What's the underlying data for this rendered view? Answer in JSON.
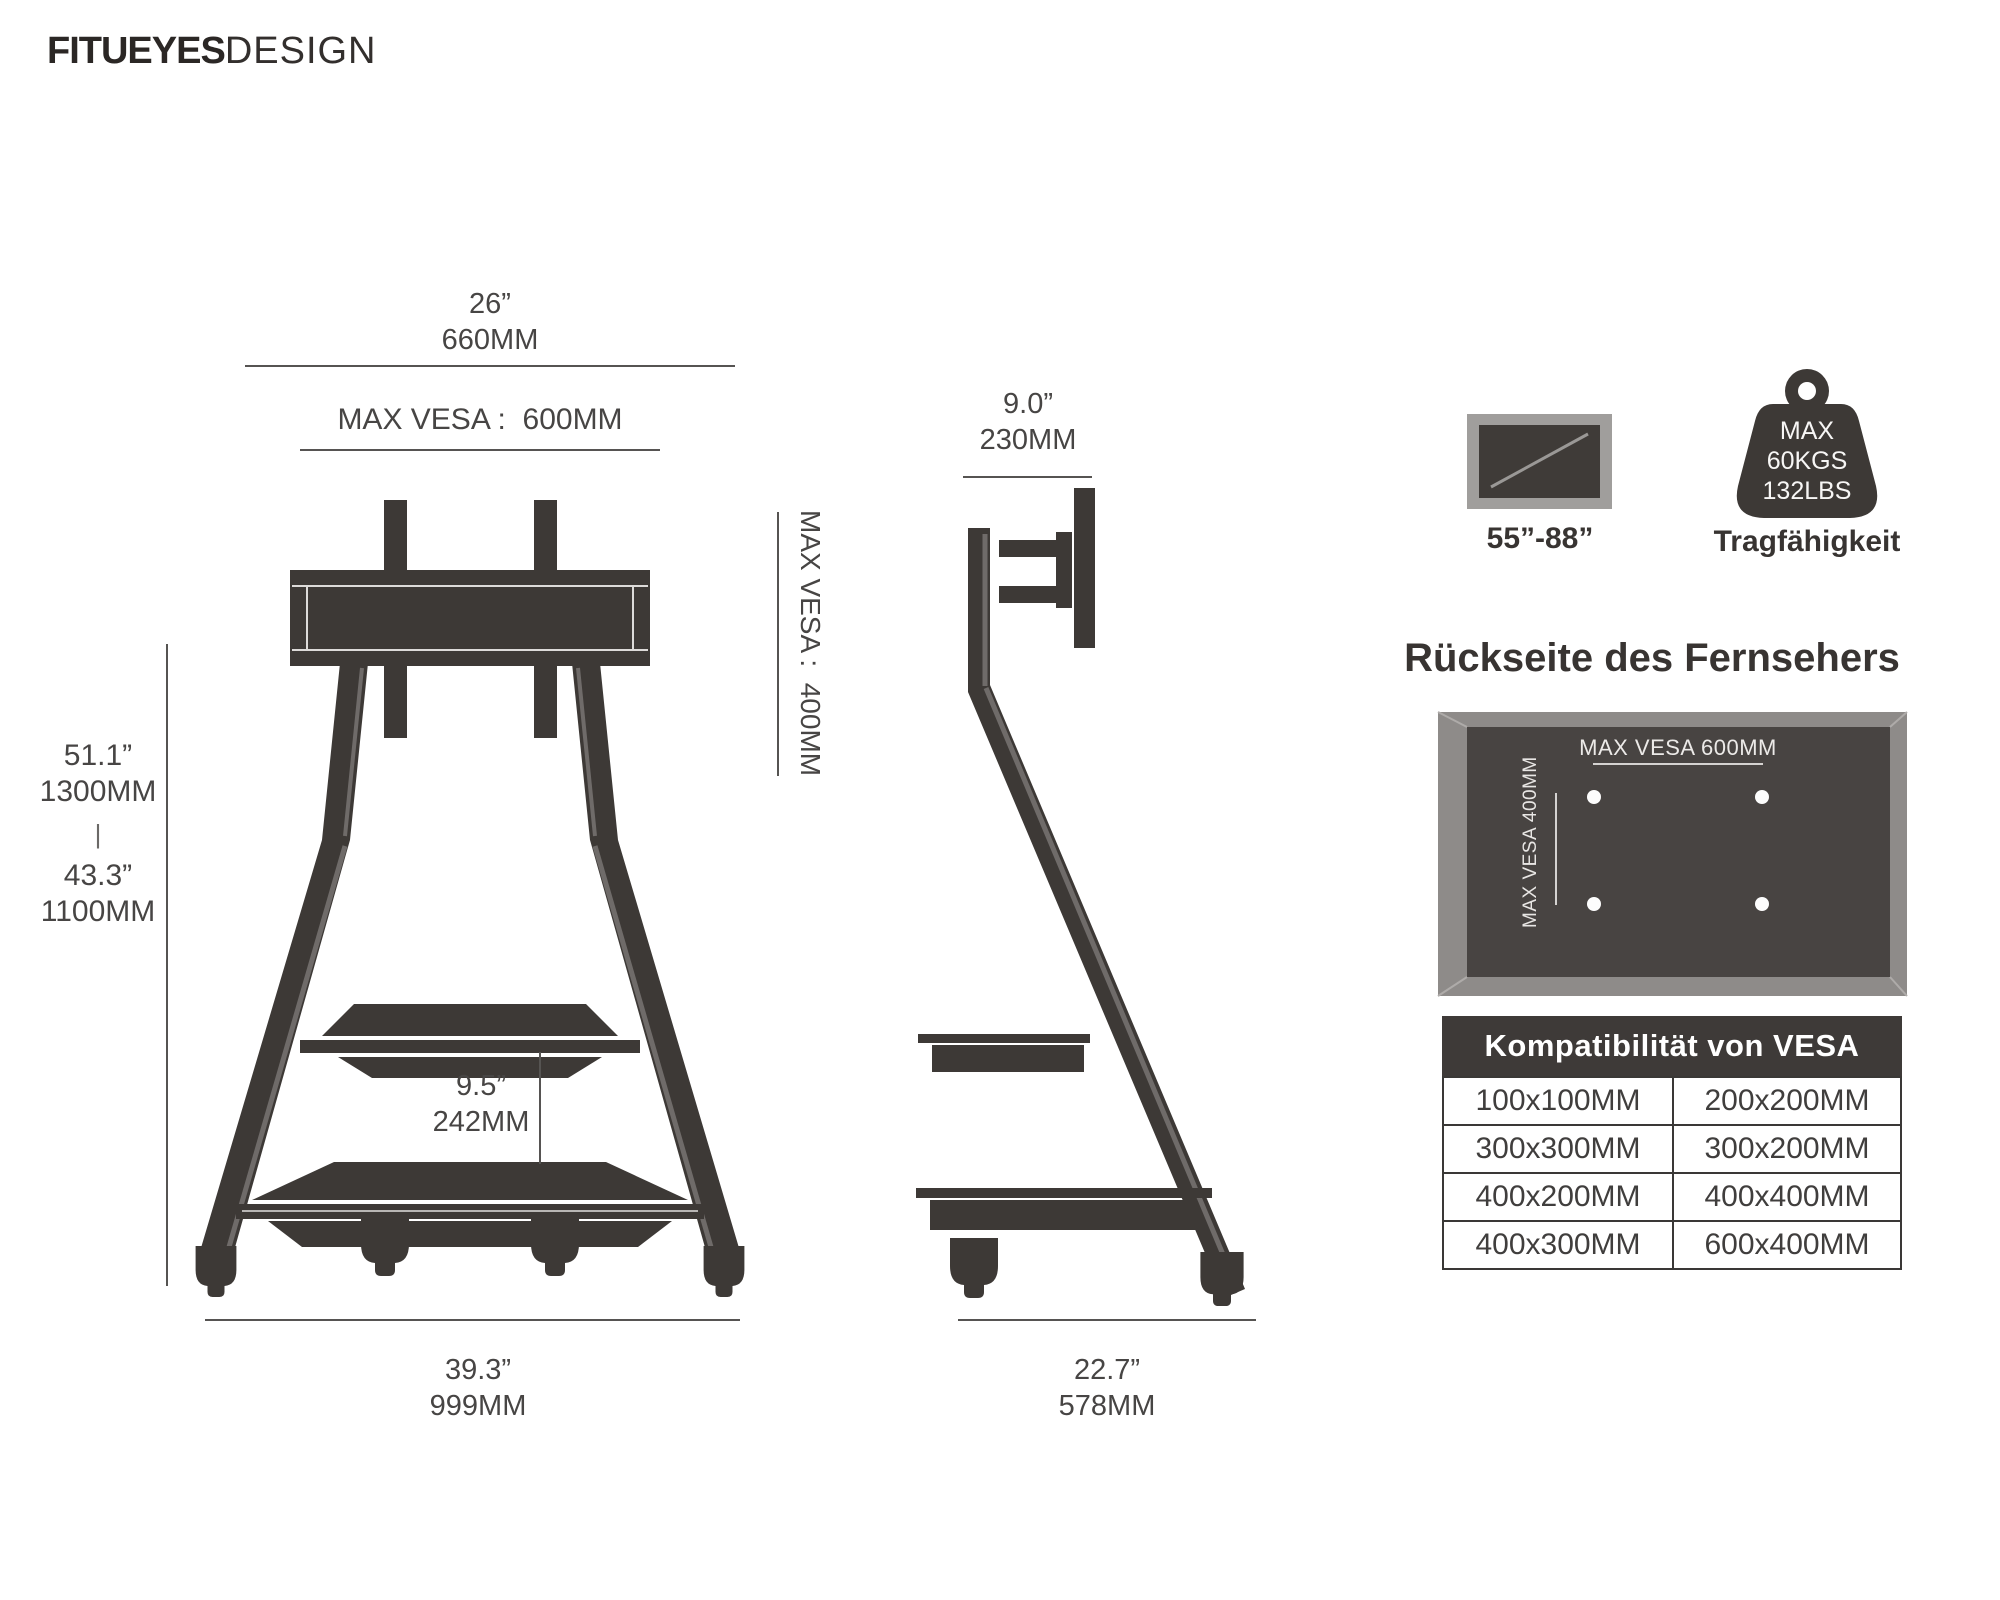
{
  "logo": {
    "bold": "FITUEYES",
    "light": "DESIGN"
  },
  "front_view": {
    "top_width_in": "26”",
    "top_width_mm": "660MM",
    "max_vesa_width": "MAX VESA :  600MM",
    "max_vesa_height": "MAX VESA :  400MM",
    "height_max_in": "51.1”",
    "height_max_mm": "1300MM",
    "height_separator": "|",
    "height_min_in": "43.3”",
    "height_min_mm": "1100MM",
    "shelf_gap_in": "9.5”",
    "shelf_gap_mm": "242MM",
    "base_width_in": "39.3”",
    "base_width_mm": "999MM"
  },
  "side_view": {
    "top_depth_in": "9.0”",
    "top_depth_mm": "230MM",
    "base_depth_in": "22.7”",
    "base_depth_mm": "578MM"
  },
  "badges": {
    "tv_size_range": "55”-88”",
    "weight_max": "MAX",
    "weight_kgs": "60KGS",
    "weight_lbs": "132LBS",
    "weight_label": "Tragfähigkeit"
  },
  "back_panel": {
    "title": "Rückseite des Fernsehers",
    "vesa_width_label": "MAX VESA 600MM",
    "vesa_height_label": "MAX VESA 400MM"
  },
  "vesa_table": {
    "header": "Kompatibilität von VESA",
    "rows": [
      [
        "100x100MM",
        "200x200MM"
      ],
      [
        "300x300MM",
        "300x200MM"
      ],
      [
        "400x200MM",
        "400x400MM"
      ],
      [
        "400x300MM",
        "600x400MM"
      ]
    ]
  },
  "colors": {
    "silhouette": "#3d3936",
    "highlight": "#6f6b69",
    "frame_gray": "#8e8b89",
    "panel_inner": "#484442",
    "dimension_line": "#565452",
    "table_header_bg": "#3e3a38",
    "text": "#474544"
  }
}
